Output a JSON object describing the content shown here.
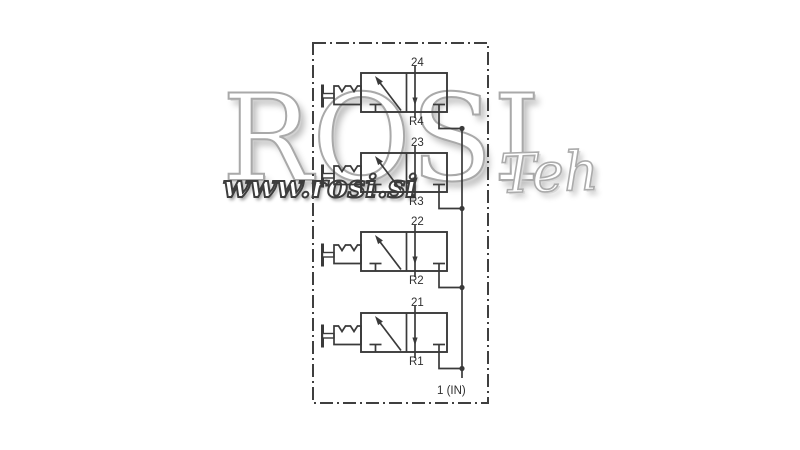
{
  "diagram": {
    "title": "pneumatic 3/2 valve bank schematic",
    "valves": [
      {
        "id": "valve-24",
        "outlet_label": "24",
        "exhaust_label": "R4"
      },
      {
        "id": "valve-23",
        "outlet_label": "23",
        "exhaust_label": "R3"
      },
      {
        "id": "valve-22",
        "outlet_label": "22",
        "exhaust_label": "R2"
      },
      {
        "id": "valve-21",
        "outlet_label": "21",
        "exhaust_label": "R1"
      }
    ],
    "supply_label": "1 (IN)"
  },
  "watermark": {
    "brand": "ROSI",
    "brand_suffix": "Teh",
    "url": "www.rosi.si"
  },
  "colors": {
    "line": "#3a3a3a",
    "label": "#2f2f2f",
    "watermark_outline": "#a9a9a9",
    "url_outline": "#3d3d3d",
    "background": "#ffffff"
  }
}
